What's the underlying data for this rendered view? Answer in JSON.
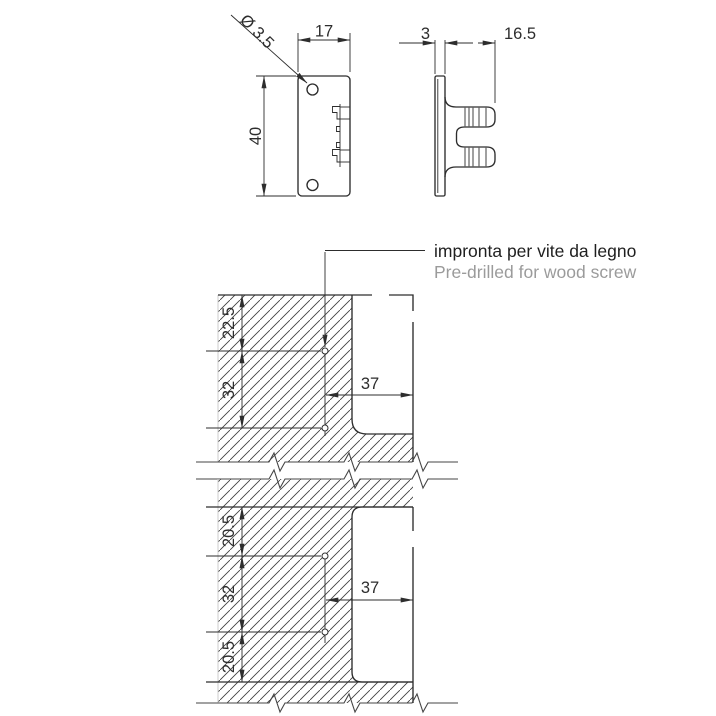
{
  "drawing": {
    "front_view": {
      "width_dim": "17",
      "height_dim": "40",
      "hole_dim": "Ø 3.5"
    },
    "side_view": {
      "thickness_dim": "3",
      "depth_dim": "16.5"
    },
    "note": {
      "italian": "impronta per vite da legno",
      "english": "Pre-drilled for wood screw"
    },
    "top_section": {
      "edge_to_first_screw": "22.5",
      "screw_spacing": "32",
      "mount_depth": "37"
    },
    "bottom_section": {
      "edge_to_first_screw": "20.5",
      "screw_spacing": "32",
      "last_screw_to_edge": "20.5",
      "mount_depth": "37"
    },
    "colors": {
      "line": "#2d2d2d",
      "note_primary": "#1f1f1f",
      "note_secondary": "#9b9b9b",
      "hatch": "#3f3f3f",
      "faint_edge": "#cccccc",
      "background": "#ffffff"
    }
  }
}
